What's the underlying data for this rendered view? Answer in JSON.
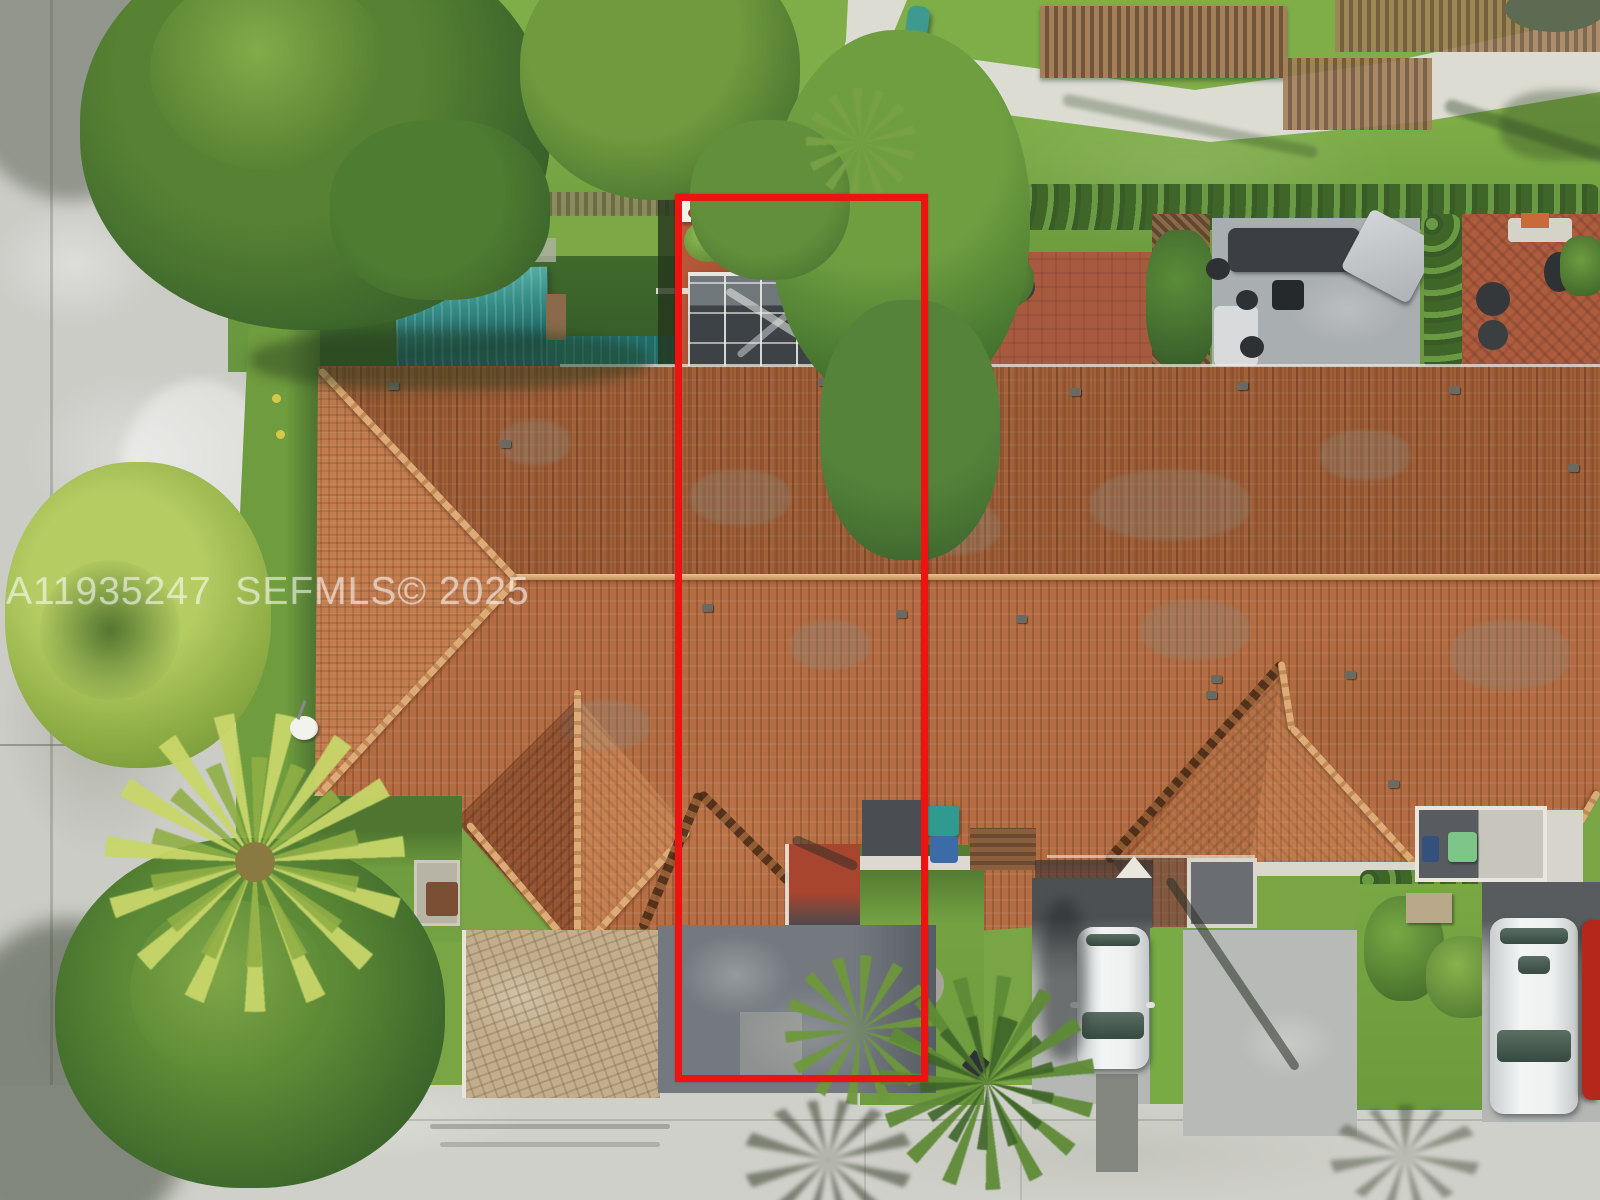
{
  "image": {
    "kind": "aerial-drone-photo",
    "subject": "row of townhouses with terracotta barrel-tile roofs, backyards with patios at top, driveways and street at bottom; one unit outlined in red",
    "width_px": 1600,
    "height_px": 1200
  },
  "watermark": {
    "text": "A11935247  SEFMLS© 2025"
  },
  "highlight": {
    "label": "subject-unit-outline",
    "shape": "rectangle",
    "color": "#ee1310"
  },
  "palette": {
    "roof_tile": "#b46c42",
    "roof_ridge": "#dcab77",
    "lawn_green": "#79a545",
    "tree_dark_green": "#3d662c",
    "street_concrete": "#cbccc6",
    "asphalt_driveway": "#73797e",
    "paver_driveway": "#c2ae8c",
    "teal_awning": "#2f8a84",
    "backyard_red_patio": "#a8452f",
    "white_car": "#eef0f0",
    "red_car": "#b5271b",
    "recycle_bin_teal": "#2f9a8d",
    "trash_bin_green": "#7cc487"
  }
}
